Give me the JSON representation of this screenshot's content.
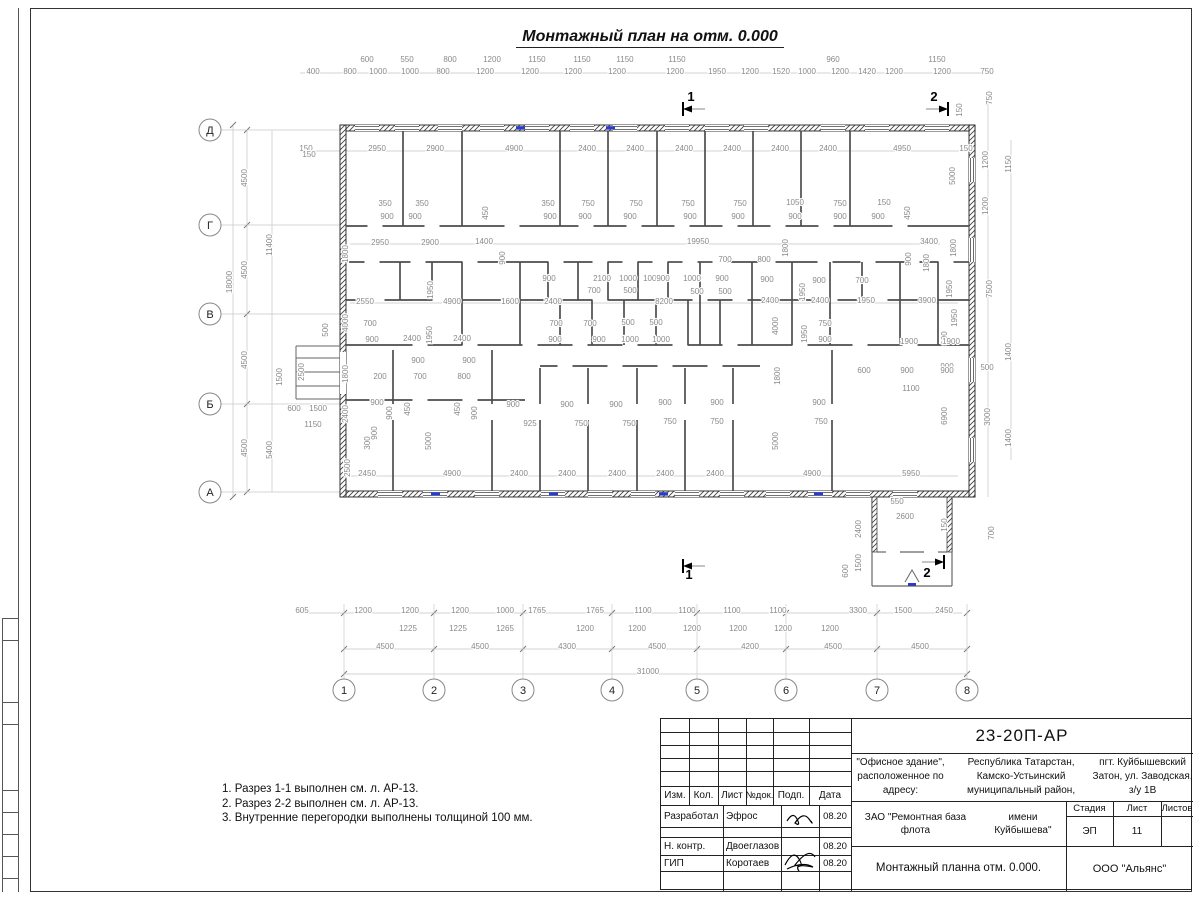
{
  "title": "Монтажный план на отм. 0.000",
  "notes": [
    "1. Разрез 1-1 выполнен см. л. АР-13.",
    "2. Разрез 2-2 выполнен см. л. АР-13.",
    "3. Внутренние перегородки выполнены толщиной 100 мм."
  ],
  "title_block": {
    "doc_number": "23-20П-АР",
    "object_lines": [
      "\"Офисное здание\", расположенное по адресу:",
      "Республика Татарстан, Камско-Устьинский муниципальный район,",
      "пгт. Куйбышевский Затон, ул. Заводская, з/у 1В"
    ],
    "columns": [
      "Изм.",
      "Кол.",
      "Лист",
      "№док.",
      "Подп.",
      "Дата"
    ],
    "signature_rows": [
      {
        "role": "Разработал",
        "name": "Эфрос",
        "date": "08.20"
      },
      {
        "role": "Н. контр.",
        "name": "Двоеглазов",
        "date": "08.20"
      },
      {
        "role": "ГИП",
        "name": "Коротаев",
        "date": "08.20"
      }
    ],
    "client_lines": [
      "ЗАО \"Ремонтная база флота",
      "имени Куйбышева\""
    ],
    "stage_label": "Стадия",
    "sheet_label": "Лист",
    "sheets_label": "Листов",
    "stage": "ЭП",
    "sheet": "11",
    "sheets": "",
    "drawing_name_lines": [
      "Монтажный план",
      "на отм. 0.000."
    ],
    "company": "ООО \"Альянс\""
  },
  "plan": {
    "axes_vertical": [
      [
        "1",
        344
      ],
      [
        "2",
        434
      ],
      [
        "3",
        523
      ],
      [
        "4",
        612
      ],
      [
        "5",
        697
      ],
      [
        "6",
        786
      ],
      [
        "7",
        877
      ],
      [
        "8",
        967
      ]
    ],
    "axes_horizontal": [
      [
        "Д",
        130
      ],
      [
        "Г",
        225
      ],
      [
        "В",
        314
      ],
      [
        "Б",
        404
      ],
      [
        "А",
        492
      ]
    ],
    "section_marks": [
      [
        "1",
        691,
        101
      ],
      [
        "2",
        934,
        101
      ],
      [
        "1",
        689,
        579
      ],
      [
        "2",
        927,
        577
      ]
    ],
    "labels": [
      [
        367,
        62,
        "600"
      ],
      [
        407,
        62,
        "550"
      ],
      [
        450,
        62,
        "800"
      ],
      [
        492,
        62,
        "1200"
      ],
      [
        537,
        62,
        "1150"
      ],
      [
        582,
        62,
        "1150"
      ],
      [
        625,
        62,
        "1150"
      ],
      [
        677,
        62,
        "1150"
      ],
      [
        833,
        62,
        "960"
      ],
      [
        937,
        62,
        "1150"
      ],
      [
        313,
        74,
        "400"
      ],
      [
        350,
        74,
        "800"
      ],
      [
        378,
        74,
        "1000"
      ],
      [
        410,
        74,
        "1000"
      ],
      [
        443,
        74,
        "800"
      ],
      [
        485,
        74,
        "1200"
      ],
      [
        530,
        74,
        "1200"
      ],
      [
        573,
        74,
        "1200"
      ],
      [
        617,
        74,
        "1200"
      ],
      [
        675,
        74,
        "1200"
      ],
      [
        717,
        74,
        "1950"
      ],
      [
        750,
        74,
        "1200"
      ],
      [
        781,
        74,
        "1520"
      ],
      [
        807,
        74,
        "1000"
      ],
      [
        840,
        74,
        "1200"
      ],
      [
        867,
        74,
        "1420"
      ],
      [
        894,
        74,
        "1200"
      ],
      [
        942,
        74,
        "1200"
      ],
      [
        987,
        74,
        "750"
      ],
      [
        306,
        151,
        "150"
      ],
      [
        377,
        151,
        "2950"
      ],
      [
        435,
        151,
        "2900"
      ],
      [
        514,
        151,
        "4900"
      ],
      [
        587,
        151,
        "2400"
      ],
      [
        635,
        151,
        "2400"
      ],
      [
        684,
        151,
        "2400"
      ],
      [
        732,
        151,
        "2400"
      ],
      [
        780,
        151,
        "2400"
      ],
      [
        828,
        151,
        "2400"
      ],
      [
        902,
        151,
        "4950"
      ],
      [
        966,
        151,
        "150"
      ],
      [
        232,
        282,
        "18000",
        1
      ],
      [
        247,
        178,
        "4500",
        1
      ],
      [
        247,
        270,
        "4500",
        1
      ],
      [
        247,
        360,
        "4500",
        1
      ],
      [
        247,
        448,
        "4500",
        1
      ],
      [
        272,
        245,
        "11400",
        1
      ],
      [
        272,
        450,
        "5400",
        1
      ],
      [
        309,
        157,
        "150"
      ],
      [
        328,
        330,
        "500",
        1
      ],
      [
        282,
        377,
        "1500",
        1
      ],
      [
        304,
        372,
        "2500",
        1
      ],
      [
        294,
        411,
        "600"
      ],
      [
        318,
        411,
        "1500"
      ],
      [
        313,
        427,
        "1150"
      ],
      [
        992,
        98,
        "750",
        1
      ],
      [
        962,
        110,
        "150",
        1
      ],
      [
        1011,
        164,
        "1150",
        1
      ],
      [
        988,
        160,
        "1200",
        1
      ],
      [
        955,
        176,
        "5000",
        1
      ],
      [
        988,
        206,
        "1200",
        1
      ],
      [
        956,
        248,
        "1800",
        1
      ],
      [
        952,
        289,
        "1950",
        1
      ],
      [
        992,
        289,
        "7500",
        1
      ],
      [
        957,
        318,
        "1950",
        1
      ],
      [
        947,
        338,
        "900",
        1
      ],
      [
        1011,
        352,
        "1400",
        1
      ],
      [
        987,
        370,
        "500"
      ],
      [
        947,
        369,
        "900"
      ],
      [
        947,
        416,
        "6900",
        1
      ],
      [
        990,
        417,
        "3000",
        1
      ],
      [
        1011,
        438,
        "1400",
        1
      ],
      [
        302,
        613,
        "605"
      ],
      [
        363,
        613,
        "1200"
      ],
      [
        410,
        613,
        "1200"
      ],
      [
        460,
        613,
        "1200"
      ],
      [
        505,
        613,
        "1000"
      ],
      [
        537,
        613,
        "1765"
      ],
      [
        595,
        613,
        "1765"
      ],
      [
        643,
        613,
        "1100"
      ],
      [
        687,
        613,
        "1100"
      ],
      [
        732,
        613,
        "1100"
      ],
      [
        778,
        613,
        "1100"
      ],
      [
        858,
        613,
        "3300"
      ],
      [
        903,
        613,
        "1500"
      ],
      [
        944,
        613,
        "2450"
      ],
      [
        408,
        631,
        "1225"
      ],
      [
        458,
        631,
        "1225"
      ],
      [
        505,
        631,
        "1265"
      ],
      [
        585,
        631,
        "1200"
      ],
      [
        637,
        631,
        "1200"
      ],
      [
        692,
        631,
        "1200"
      ],
      [
        738,
        631,
        "1200"
      ],
      [
        783,
        631,
        "1200"
      ],
      [
        830,
        631,
        "1200"
      ],
      [
        385,
        649,
        "4500"
      ],
      [
        480,
        649,
        "4500"
      ],
      [
        567,
        649,
        "4300"
      ],
      [
        657,
        649,
        "4500"
      ],
      [
        750,
        649,
        "4200"
      ],
      [
        833,
        649,
        "4500"
      ],
      [
        920,
        649,
        "4500"
      ],
      [
        648,
        674,
        "31000"
      ],
      [
        385,
        206,
        "350"
      ],
      [
        422,
        206,
        "350"
      ],
      [
        488,
        213,
        "450",
        1
      ],
      [
        548,
        206,
        "350"
      ],
      [
        588,
        206,
        "750"
      ],
      [
        636,
        206,
        "750"
      ],
      [
        688,
        206,
        "750"
      ],
      [
        740,
        206,
        "750"
      ],
      [
        795,
        205,
        "1050"
      ],
      [
        840,
        206,
        "750"
      ],
      [
        884,
        205,
        "150"
      ],
      [
        910,
        213,
        "450",
        1
      ],
      [
        387,
        219,
        "900"
      ],
      [
        415,
        219,
        "900"
      ],
      [
        550,
        219,
        "900"
      ],
      [
        585,
        219,
        "900"
      ],
      [
        630,
        219,
        "900"
      ],
      [
        690,
        219,
        "900"
      ],
      [
        738,
        219,
        "900"
      ],
      [
        795,
        219,
        "900"
      ],
      [
        840,
        219,
        "900"
      ],
      [
        878,
        219,
        "900"
      ],
      [
        380,
        245,
        "2950"
      ],
      [
        430,
        245,
        "2900"
      ],
      [
        484,
        244,
        "1400"
      ],
      [
        505,
        258,
        "900",
        1
      ],
      [
        698,
        244,
        "19950"
      ],
      [
        929,
        244,
        "3400"
      ],
      [
        788,
        248,
        "1800",
        1
      ],
      [
        911,
        259,
        "900",
        1
      ],
      [
        929,
        263,
        "1800",
        1
      ],
      [
        348,
        254,
        "1800",
        1
      ],
      [
        725,
        262,
        "700"
      ],
      [
        764,
        262,
        "800"
      ],
      [
        433,
        290,
        "1950",
        1
      ],
      [
        365,
        304,
        "2550"
      ],
      [
        452,
        304,
        "4900"
      ],
      [
        510,
        304,
        "1600"
      ],
      [
        553,
        304,
        "2400"
      ],
      [
        664,
        304,
        "8200"
      ],
      [
        770,
        303,
        "2400"
      ],
      [
        820,
        303,
        "2400"
      ],
      [
        866,
        303,
        "1950"
      ],
      [
        927,
        303,
        "3900"
      ],
      [
        549,
        281,
        "900"
      ],
      [
        602,
        281,
        "2100"
      ],
      [
        628,
        281,
        "1000"
      ],
      [
        652,
        281,
        "1000"
      ],
      [
        594,
        293,
        "700"
      ],
      [
        630,
        293,
        "500"
      ],
      [
        663,
        281,
        "900"
      ],
      [
        692,
        281,
        "1000"
      ],
      [
        722,
        281,
        "900"
      ],
      [
        767,
        282,
        "900"
      ],
      [
        697,
        294,
        "500"
      ],
      [
        725,
        294,
        "500"
      ],
      [
        819,
        283,
        "900"
      ],
      [
        805,
        292,
        "1950",
        1
      ],
      [
        862,
        283,
        "700"
      ],
      [
        348,
        323,
        "4000",
        1
      ],
      [
        370,
        326,
        "700"
      ],
      [
        372,
        342,
        "900"
      ],
      [
        412,
        341,
        "2400"
      ],
      [
        432,
        335,
        "1950",
        1
      ],
      [
        462,
        341,
        "2400"
      ],
      [
        556,
        326,
        "700"
      ],
      [
        590,
        326,
        "700"
      ],
      [
        628,
        325,
        "500"
      ],
      [
        656,
        325,
        "500"
      ],
      [
        555,
        342,
        "900"
      ],
      [
        599,
        342,
        "900"
      ],
      [
        630,
        342,
        "1000"
      ],
      [
        661,
        342,
        "1000"
      ],
      [
        778,
        326,
        "4000",
        1
      ],
      [
        807,
        334,
        "1950",
        1
      ],
      [
        825,
        326,
        "750"
      ],
      [
        825,
        342,
        "900"
      ],
      [
        909,
        344,
        "1900"
      ],
      [
        951,
        344,
        "1900"
      ],
      [
        418,
        363,
        "900"
      ],
      [
        469,
        363,
        "900"
      ],
      [
        420,
        379,
        "700"
      ],
      [
        464,
        379,
        "800"
      ],
      [
        348,
        374,
        "1800",
        1
      ],
      [
        380,
        379,
        "200"
      ],
      [
        780,
        376,
        "1800",
        1
      ],
      [
        864,
        373,
        "600"
      ],
      [
        907,
        373,
        "900"
      ],
      [
        947,
        373,
        "900"
      ],
      [
        911,
        391,
        "1100"
      ],
      [
        377,
        405,
        "900"
      ],
      [
        392,
        413,
        "900",
        1
      ],
      [
        410,
        409,
        "450",
        1
      ],
      [
        460,
        409,
        "450",
        1
      ],
      [
        477,
        413,
        "900",
        1
      ],
      [
        513,
        407,
        "900"
      ],
      [
        567,
        407,
        "900"
      ],
      [
        616,
        407,
        "900"
      ],
      [
        665,
        405,
        "900"
      ],
      [
        717,
        405,
        "900"
      ],
      [
        819,
        405,
        "900"
      ],
      [
        348,
        414,
        "2400",
        1
      ],
      [
        377,
        433,
        "900",
        1
      ],
      [
        370,
        443,
        "300",
        1
      ],
      [
        431,
        441,
        "5000",
        1
      ],
      [
        350,
        468,
        "2500",
        1
      ],
      [
        530,
        426,
        "925"
      ],
      [
        581,
        426,
        "750"
      ],
      [
        629,
        426,
        "750"
      ],
      [
        670,
        424,
        "750"
      ],
      [
        717,
        424,
        "750"
      ],
      [
        821,
        424,
        "750"
      ],
      [
        778,
        441,
        "5000",
        1
      ],
      [
        367,
        476,
        "2450"
      ],
      [
        452,
        476,
        "4900"
      ],
      [
        519,
        476,
        "2400"
      ],
      [
        567,
        476,
        "2400"
      ],
      [
        617,
        476,
        "2400"
      ],
      [
        665,
        476,
        "2400"
      ],
      [
        715,
        476,
        "2400"
      ],
      [
        812,
        476,
        "4900"
      ],
      [
        911,
        476,
        "5950"
      ],
      [
        897,
        504,
        "550"
      ],
      [
        905,
        519,
        "2600"
      ],
      [
        947,
        525,
        "150",
        1
      ],
      [
        861,
        529,
        "2400",
        1
      ],
      [
        861,
        563,
        "1500",
        1
      ],
      [
        848,
        571,
        "600",
        1
      ],
      [
        994,
        533,
        "700",
        1
      ]
    ]
  }
}
